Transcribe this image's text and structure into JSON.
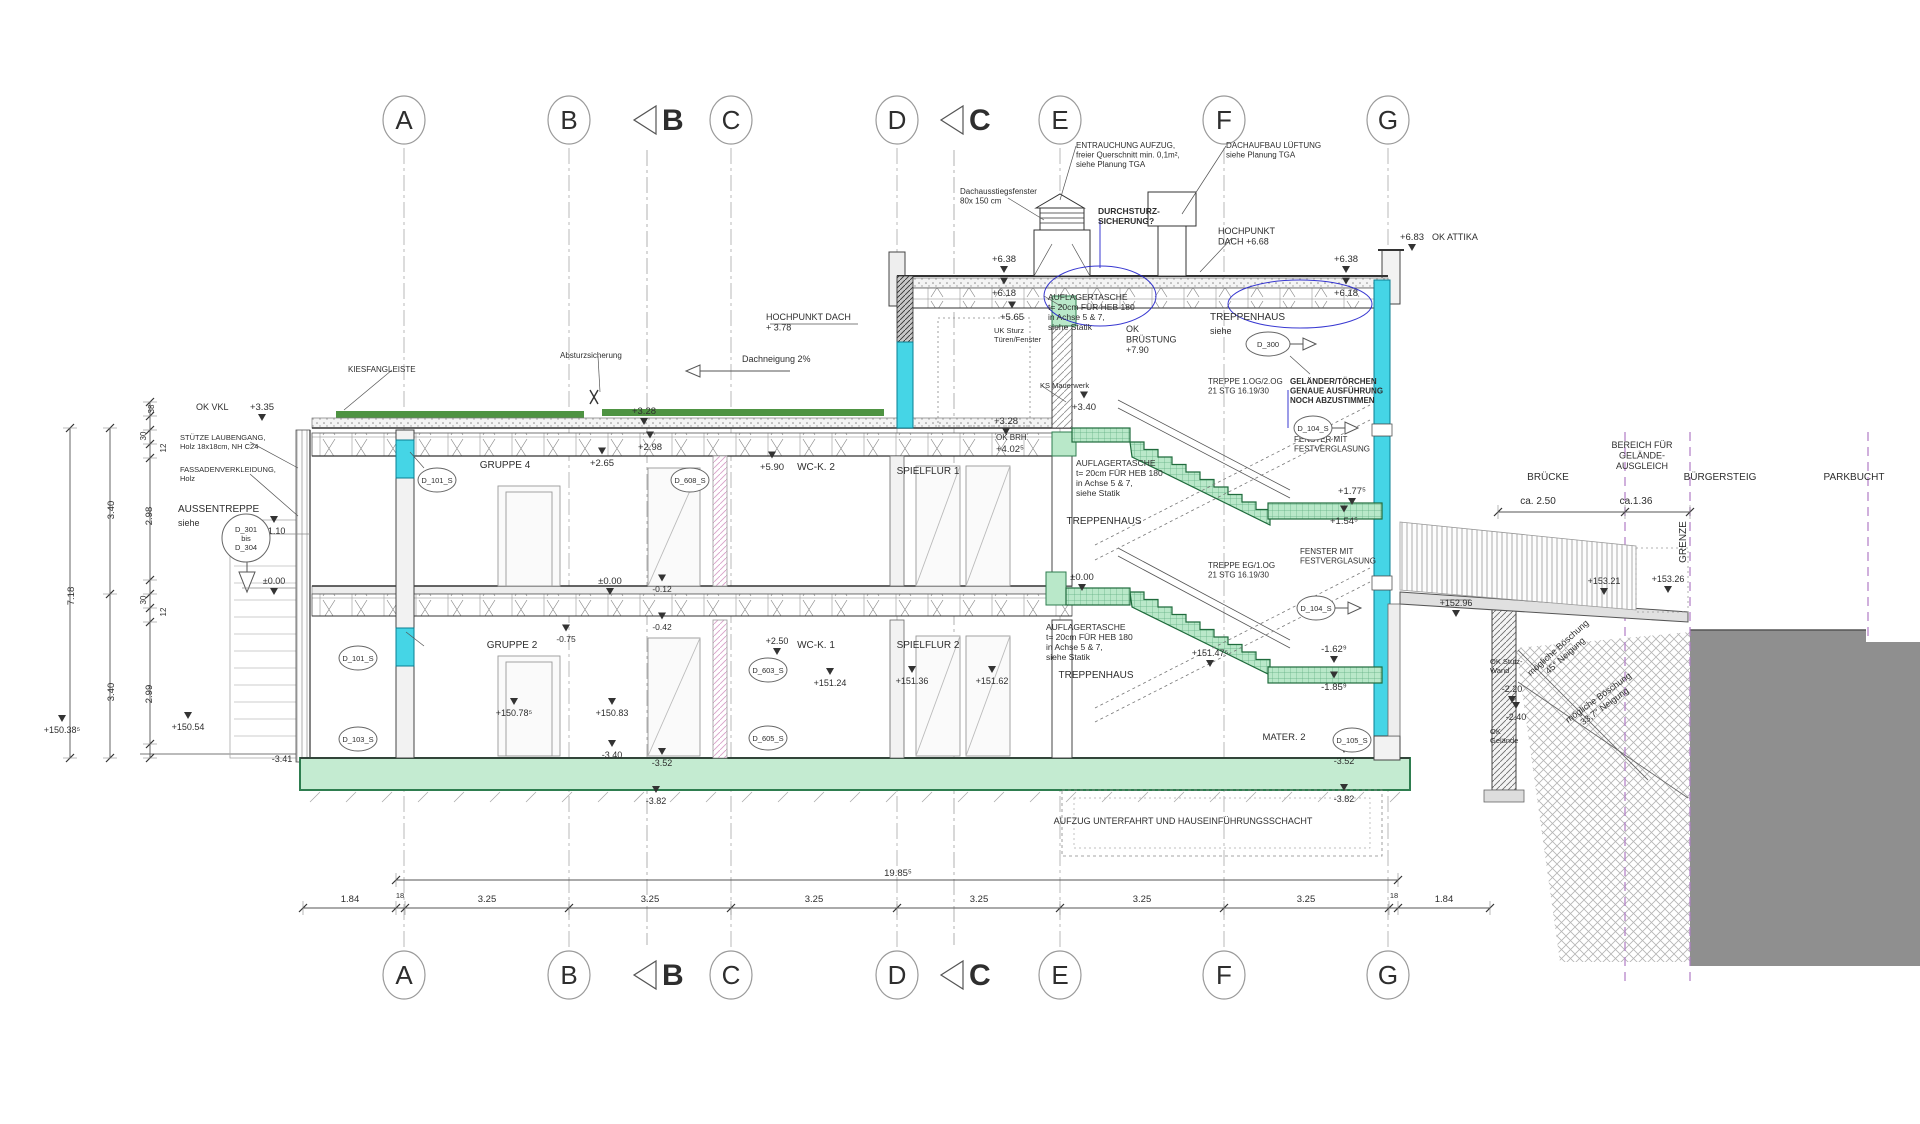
{
  "colors": {
    "blue_note": "#1a1ad2",
    "green_stair": "#b9e8c9",
    "green_stair_line": "#1f6b3c",
    "green_roof": "#4e9342",
    "green_slab": "#c4ebd1",
    "cyan": "#45d5e6",
    "cyan_line": "#0a7f93",
    "ground_gray": "#8f8f8f",
    "purple_dash": "#b07cc6"
  },
  "grid": {
    "letters": [
      "A",
      "B",
      "C",
      "D",
      "E",
      "F",
      "G"
    ],
    "x": [
      404,
      569,
      731,
      897,
      1060,
      1224,
      1388
    ],
    "top_y": 120,
    "bottom_y": 975,
    "section_markers": [
      {
        "label": "B",
        "x": 678
      },
      {
        "label": "C",
        "x": 985
      }
    ]
  },
  "annotations": [
    {
      "t": [
        "ENTRAUCHUNG AUFZUG,",
        "freier Querschnitt min. 0,1m²,",
        "siehe Planung TGA"
      ],
      "x": 1076,
      "y": 148,
      "s": 8,
      "a": "s"
    },
    {
      "t": [
        "DACHAUFBAU LÜFTUNG",
        "siehe Planung TGA"
      ],
      "x": 1226,
      "y": 148,
      "s": 8,
      "a": "s"
    },
    {
      "t": [
        "Dachausstiegsfenster",
        "80x 150 cm"
      ],
      "x": 960,
      "y": 194,
      "s": 8,
      "a": "s"
    },
    {
      "t": [
        "DURCHSTURZ-",
        "SICHERUNG?"
      ],
      "x": 1098,
      "y": 214,
      "s": 8.5,
      "a": "s",
      "c": "blue",
      "b": 1
    },
    {
      "t": [
        "HOCHPUNKT",
        "DACH +6.68"
      ],
      "x": 1218,
      "y": 234,
      "s": 9,
      "a": "s"
    },
    {
      "t": [
        "+6.83"
      ],
      "x": 1412,
      "y": 240,
      "s": 9.5,
      "tri": "d"
    },
    {
      "t": [
        "OK ATTIKA"
      ],
      "x": 1432,
      "y": 240,
      "s": 9,
      "a": "s"
    },
    {
      "t": [
        "+6.38"
      ],
      "x": 1004,
      "y": 262,
      "tri": "d"
    },
    {
      "t": [
        "+6.38"
      ],
      "x": 1346,
      "y": 262,
      "tri": "d"
    },
    {
      "t": [
        "+6.18"
      ],
      "x": 1004,
      "y": 296,
      "tri": "u"
    },
    {
      "t": [
        "+6.18"
      ],
      "x": 1346,
      "y": 296,
      "tri": "u"
    },
    {
      "t": [
        "+5.65"
      ],
      "x": 1012,
      "y": 320,
      "tri": "u"
    },
    {
      "t": [
        "UK Sturz",
        "Türen/Fenster"
      ],
      "x": 994,
      "y": 333,
      "s": 7.5,
      "a": "s"
    },
    {
      "t": [
        "OK BRH"
      ],
      "x": 996,
      "y": 440,
      "s": 8,
      "a": "s"
    },
    {
      "t": [
        "+4.02⁵"
      ],
      "x": 996,
      "y": 452,
      "s": 9.5,
      "a": "s"
    },
    {
      "t": [
        "+3.28"
      ],
      "x": 1006,
      "y": 424,
      "tri": "d"
    },
    {
      "t": [
        "+3.40"
      ],
      "x": 1084,
      "y": 410,
      "tri": "u"
    },
    {
      "t": [
        "KS Mauerwerk"
      ],
      "x": 1040,
      "y": 388,
      "s": 7.5,
      "a": "s"
    },
    {
      "t": [
        "HOCHPUNKT DACH",
        "+ 3.78"
      ],
      "x": 766,
      "y": 320,
      "s": 9,
      "a": "s"
    },
    {
      "t": [
        "Dachneigung 2%"
      ],
      "x": 742,
      "y": 362,
      "s": 9,
      "a": "s"
    },
    {
      "t": [
        "KIESFANGLEISTE"
      ],
      "x": 348,
      "y": 372,
      "s": 8,
      "a": "s"
    },
    {
      "t": [
        "Absturzsicherung"
      ],
      "x": 560,
      "y": 358,
      "s": 8,
      "a": "s"
    },
    {
      "t": [
        "+3.28"
      ],
      "x": 644,
      "y": 414,
      "tri": "d"
    },
    {
      "t": [
        "+2.98"
      ],
      "x": 650,
      "y": 450,
      "tri": "u"
    },
    {
      "t": [
        "+2.65"
      ],
      "x": 602,
      "y": 466,
      "tri": "u"
    },
    {
      "t": [
        "OK VKL"
      ],
      "x": 196,
      "y": 410,
      "s": 9,
      "a": "s"
    },
    {
      "t": [
        "+3.35"
      ],
      "x": 262,
      "y": 410,
      "s": 9.5,
      "tri": "d"
    },
    {
      "t": [
        "STÜTZE LAUBENGANG,",
        "Holz 18x18cm, NH C24"
      ],
      "x": 180,
      "y": 440,
      "s": 7.5,
      "a": "s"
    },
    {
      "t": [
        "FASSADENVERKLEIDUNG,",
        "Holz"
      ],
      "x": 180,
      "y": 472,
      "s": 7.5,
      "a": "s"
    },
    {
      "t": [
        "AUSSENTREPPE"
      ],
      "x": 178,
      "y": 512,
      "s": 10,
      "a": "s"
    },
    {
      "t": [
        "siehe"
      ],
      "x": 178,
      "y": 526,
      "s": 9,
      "a": "s"
    },
    {
      "t": [
        "GRUPPE 4"
      ],
      "x": 505,
      "y": 468,
      "s": 10
    },
    {
      "t": [
        "+5.90"
      ],
      "x": 772,
      "y": 470,
      "tri": "u"
    },
    {
      "t": [
        "WC-K. 2"
      ],
      "x": 816,
      "y": 470,
      "s": 10
    },
    {
      "t": [
        "SPIELFLUR 1"
      ],
      "x": 928,
      "y": 474,
      "s": 10
    },
    {
      "t": [
        "AUFLAGERTASCHE",
        "t= 20cm FÜR HEB 180",
        "in Achse 5 & 7,",
        "siehe Statik"
      ],
      "x": 1048,
      "y": 300,
      "s": 8.5,
      "a": "s"
    },
    {
      "t": [
        "OK",
        "BRÜSTUNG",
        "+7.90"
      ],
      "x": 1126,
      "y": 332,
      "s": 9,
      "a": "s"
    },
    {
      "t": [
        "TREPPENHAUS"
      ],
      "x": 1210,
      "y": 320,
      "s": 10,
      "a": "s"
    },
    {
      "t": [
        "siehe"
      ],
      "x": 1210,
      "y": 334,
      "s": 9,
      "a": "s"
    },
    {
      "t": [
        "TREPPE 1.OG/2.OG",
        "21 STG 16.19/30"
      ],
      "x": 1208,
      "y": 384,
      "s": 8,
      "a": "s"
    },
    {
      "t": [
        "GELÄNDER/TÖRCHEN",
        "GENAUE AUSFÜHRUNG",
        "NOCH ABZUSTIMMEN"
      ],
      "x": 1290,
      "y": 384,
      "s": 8,
      "a": "s",
      "c": "blue",
      "b": 1
    },
    {
      "t": [
        "FENSTER MIT",
        "FESTVERGLASUNG"
      ],
      "x": 1294,
      "y": 442,
      "s": 8,
      "a": "s"
    },
    {
      "t": [
        "+1.77⁵"
      ],
      "x": 1352,
      "y": 494,
      "s": 9.5,
      "tri": "d"
    },
    {
      "t": [
        "+1.54⁵"
      ],
      "x": 1344,
      "y": 524,
      "s": 9.5,
      "tri": "u"
    },
    {
      "t": [
        "TREPPENHAUS"
      ],
      "x": 1104,
      "y": 524,
      "s": 10
    },
    {
      "t": [
        "AUFLAGERTASCHE",
        "t= 20cm FÜR HEB 180",
        "in Achse 5 & 7,",
        "siehe Statik"
      ],
      "x": 1076,
      "y": 466,
      "s": 8.5,
      "a": "s"
    },
    {
      "t": [
        "±0.00"
      ],
      "x": 610,
      "y": 584,
      "tri": "d"
    },
    {
      "t": [
        "-0.12"
      ],
      "x": 662,
      "y": 592,
      "s": 8.5,
      "tri": "u"
    },
    {
      "t": [
        "-0.42"
      ],
      "x": 662,
      "y": 630,
      "s": 8.5,
      "tri": "u"
    },
    {
      "t": [
        "-0.75"
      ],
      "x": 566,
      "y": 642,
      "s": 8.5,
      "tri": "u"
    },
    {
      "t": [
        "+1.10"
      ],
      "x": 274,
      "y": 534,
      "s": 9,
      "tri": "u"
    },
    {
      "t": [
        "±0.00"
      ],
      "x": 274,
      "y": 584,
      "s": 9,
      "tri": "d"
    },
    {
      "t": [
        "±0.00"
      ],
      "x": 1082,
      "y": 580,
      "tri": "d"
    },
    {
      "t": [
        "GRUPPE 2"
      ],
      "x": 512,
      "y": 648,
      "s": 10
    },
    {
      "t": [
        "+2.50"
      ],
      "x": 777,
      "y": 644,
      "s": 9,
      "tri": "d"
    },
    {
      "t": [
        "WC-K. 1"
      ],
      "x": 816,
      "y": 648,
      "s": 10
    },
    {
      "t": [
        "SPIELFLUR 2"
      ],
      "x": 928,
      "y": 648,
      "s": 10
    },
    {
      "t": [
        "+151.24"
      ],
      "x": 830,
      "y": 686,
      "s": 9,
      "tri": "u"
    },
    {
      "t": [
        "+151.36"
      ],
      "x": 912,
      "y": 684,
      "s": 9,
      "tri": "u"
    },
    {
      "t": [
        "+151.62"
      ],
      "x": 992,
      "y": 684,
      "s": 9,
      "tri": "u"
    },
    {
      "t": [
        "AUFLAGERTASCHE",
        "t= 20cm FÜR HEB 180",
        "in Achse 5 & 7,",
        "siehe Statik"
      ],
      "x": 1046,
      "y": 630,
      "s": 8.5,
      "a": "s"
    },
    {
      "t": [
        "TREPPENHAUS"
      ],
      "x": 1096,
      "y": 678,
      "s": 10
    },
    {
      "t": [
        "TREPPE EG/1.OG",
        "21 STG 16.19/30"
      ],
      "x": 1208,
      "y": 568,
      "s": 8,
      "a": "s"
    },
    {
      "t": [
        "FENSTER MIT",
        "FESTVERGLASUNG"
      ],
      "x": 1300,
      "y": 554,
      "s": 8,
      "a": "s"
    },
    {
      "t": [
        "+151.47⁵"
      ],
      "x": 1210,
      "y": 656,
      "s": 9,
      "tri": "d"
    },
    {
      "t": [
        "-1.62⁹"
      ],
      "x": 1334,
      "y": 652,
      "s": 9.5,
      "tri": "d"
    },
    {
      "t": [
        "-1.85⁹"
      ],
      "x": 1334,
      "y": 690,
      "s": 9.5,
      "tri": "u"
    },
    {
      "t": [
        "MATER. 2"
      ],
      "x": 1284,
      "y": 740,
      "s": 9.5
    },
    {
      "t": [
        "+150.78⁵"
      ],
      "x": 514,
      "y": 716,
      "s": 9,
      "tri": "u"
    },
    {
      "t": [
        "+150.83"
      ],
      "x": 612,
      "y": 716,
      "s": 9,
      "tri": "u"
    },
    {
      "t": [
        "-3.41"
      ],
      "x": 282,
      "y": 762,
      "s": 9
    },
    {
      "t": [
        "-3.40"
      ],
      "x": 612,
      "y": 758,
      "s": 9,
      "tri": "u"
    },
    {
      "t": [
        "-3.52"
      ],
      "x": 662,
      "y": 766,
      "s": 9,
      "tri": "u"
    },
    {
      "t": [
        "-3.82"
      ],
      "x": 656,
      "y": 804,
      "s": 9,
      "tri": "u"
    },
    {
      "t": [
        "-3.52"
      ],
      "x": 1344,
      "y": 764,
      "s": 9,
      "tri": "u"
    },
    {
      "t": [
        "-3.82"
      ],
      "x": 1344,
      "y": 802,
      "s": 9,
      "tri": "u"
    },
    {
      "t": [
        "+150.54"
      ],
      "x": 188,
      "y": 730,
      "s": 9,
      "tri": "u"
    },
    {
      "t": [
        "+150.38⁵"
      ],
      "x": 62,
      "y": 733,
      "s": 9,
      "tri": "u"
    },
    {
      "t": [
        "AUFZUG UNTERFAHRT UND HAUSEINFÜHRUNGSSCHACHT"
      ],
      "x": 1183,
      "y": 824,
      "s": 9
    },
    {
      "t": [
        "+152.96"
      ],
      "x": 1456,
      "y": 606,
      "s": 9,
      "tri": "d"
    },
    {
      "t": [
        "BRÜCKE"
      ],
      "x": 1548,
      "y": 480,
      "s": 10
    },
    {
      "t": [
        "BEREICH FÜR",
        "GELÄNDE-",
        "AUSGLEICH"
      ],
      "x": 1642,
      "y": 448,
      "s": 9
    },
    {
      "t": [
        "BÜRGERSTEIG"
      ],
      "x": 1720,
      "y": 480,
      "s": 10
    },
    {
      "t": [
        "PARKBUCHT"
      ],
      "x": 1854,
      "y": 480,
      "s": 10
    },
    {
      "t": [
        "ca. 2.50"
      ],
      "x": 1538,
      "y": 504,
      "s": 10
    },
    {
      "t": [
        "ca.1.36"
      ],
      "x": 1636,
      "y": 504,
      "s": 10
    },
    {
      "t": [
        "GRENZE"
      ],
      "x": 1686,
      "y": 542,
      "s": 10,
      "r": -90
    },
    {
      "t": [
        "+153.21"
      ],
      "x": 1604,
      "y": 584,
      "s": 9,
      "tri": "d"
    },
    {
      "t": [
        "+153.26"
      ],
      "x": 1668,
      "y": 582,
      "s": 9,
      "tri": "d"
    },
    {
      "t": [
        "mögliche Böschung",
        "45° Neigung"
      ],
      "x": 1560,
      "y": 650,
      "s": 9,
      "r": -42
    },
    {
      "t": [
        "mögliche Böschung",
        "33,7° Neigung"
      ],
      "x": 1600,
      "y": 700,
      "s": 9,
      "r": -36
    },
    {
      "t": [
        "OK Stütz-",
        "Wand"
      ],
      "x": 1490,
      "y": 664,
      "s": 7.5,
      "a": "s"
    },
    {
      "t": [
        "-2.20"
      ],
      "x": 1512,
      "y": 692,
      "s": 9,
      "tri": "d"
    },
    {
      "t": [
        "-2.40"
      ],
      "x": 1516,
      "y": 720,
      "s": 9,
      "tri": "u"
    },
    {
      "t": [
        "OK",
        "Gelände"
      ],
      "x": 1490,
      "y": 734,
      "s": 7.5,
      "a": "s"
    },
    {
      "t": [
        "7.18"
      ],
      "x": 74,
      "y": 596,
      "s": 9.5,
      "r": -90
    },
    {
      "t": [
        "3.40"
      ],
      "x": 114,
      "y": 510,
      "s": 9.5,
      "r": -90
    },
    {
      "t": [
        "2.98"
      ],
      "x": 152,
      "y": 516,
      "s": 9.5,
      "r": -90
    },
    {
      "t": [
        "3.40"
      ],
      "x": 114,
      "y": 692,
      "s": 9.5,
      "r": -90
    },
    {
      "t": [
        "2.99"
      ],
      "x": 152,
      "y": 694,
      "s": 9.5,
      "r": -90
    },
    {
      "t": [
        "38"
      ],
      "x": 154,
      "y": 409,
      "s": 8,
      "r": -90
    },
    {
      "t": [
        "30"
      ],
      "x": 146,
      "y": 436,
      "s": 8,
      "r": -90
    },
    {
      "t": [
        "12"
      ],
      "x": 166,
      "y": 448,
      "s": 8,
      "r": -90
    },
    {
      "t": [
        "30"
      ],
      "x": 146,
      "y": 600,
      "s": 8,
      "r": -90
    },
    {
      "t": [
        "12"
      ],
      "x": 166,
      "y": 612,
      "s": 8,
      "r": -90
    },
    {
      "t": [
        "19.85⁵"
      ],
      "x": 898,
      "y": 876,
      "s": 9.5
    },
    {
      "t": [
        "1.84"
      ],
      "x": 350,
      "y": 902,
      "s": 9.5
    },
    {
      "t": [
        "18"
      ],
      "x": 400,
      "y": 898,
      "s": 7.5
    },
    {
      "t": [
        "3.25"
      ],
      "x": 487,
      "y": 902,
      "s": 9.5
    },
    {
      "t": [
        "3.25"
      ],
      "x": 650,
      "y": 902,
      "s": 9.5
    },
    {
      "t": [
        "3.25"
      ],
      "x": 814,
      "y": 902,
      "s": 9.5
    },
    {
      "t": [
        "3.25"
      ],
      "x": 979,
      "y": 902,
      "s": 9.5
    },
    {
      "t": [
        "3.25"
      ],
      "x": 1142,
      "y": 902,
      "s": 9.5
    },
    {
      "t": [
        "3.25"
      ],
      "x": 1306,
      "y": 902,
      "s": 9.5
    },
    {
      "t": [
        "18"
      ],
      "x": 1394,
      "y": 898,
      "s": 7.5
    },
    {
      "t": [
        "1.84"
      ],
      "x": 1444,
      "y": 902,
      "s": 9.5
    }
  ],
  "tags": [
    {
      "t": [
        "D_101_S"
      ],
      "x": 437,
      "y": 480
    },
    {
      "t": [
        "D_608_S"
      ],
      "x": 690,
      "y": 480
    },
    {
      "t": [
        "D_300"
      ],
      "x": 1268,
      "y": 344,
      "r": 22,
      "arrow": 1
    },
    {
      "t": [
        "D_104_S"
      ],
      "x": 1313,
      "y": 428,
      "arrow": 1
    },
    {
      "t": [
        "D_104_S"
      ],
      "x": 1316,
      "y": 608,
      "arrow": 1
    },
    {
      "t": [
        "D_101_S"
      ],
      "x": 358,
      "y": 658
    },
    {
      "t": [
        "D_103_S"
      ],
      "x": 358,
      "y": 739
    },
    {
      "t": [
        "D_603_S"
      ],
      "x": 768,
      "y": 670
    },
    {
      "t": [
        "D_605_S"
      ],
      "x": 768,
      "y": 738
    },
    {
      "t": [
        "D_105_S"
      ],
      "x": 1352,
      "y": 740
    },
    {
      "t": [
        "D_301",
        "bis",
        "D_304"
      ],
      "x": 246,
      "y": 538,
      "r": 24
    }
  ]
}
